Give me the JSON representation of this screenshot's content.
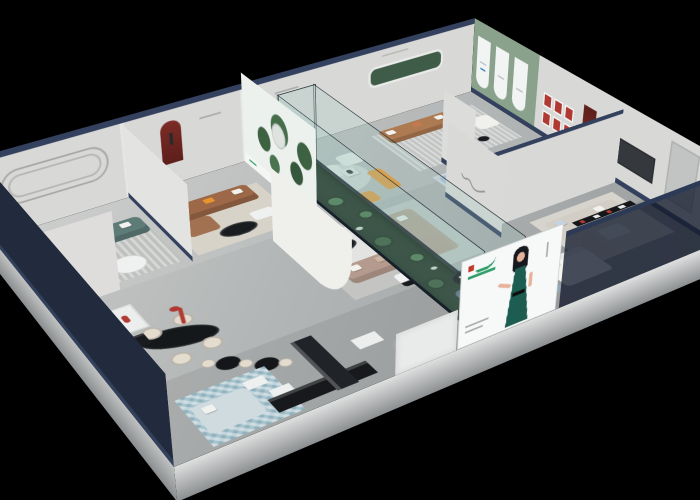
{
  "scene": {
    "description": "Isometric cutaway 3D render of a furniture showroom floor plan, dollhouse view on a black background",
    "view": "isometric-cutaway",
    "rooms": [
      {
        "id": "lounge-teal-sofa"
      },
      {
        "id": "lounge-brown-leather-sofa"
      },
      {
        "id": "statue-gallery-zone"
      },
      {
        "id": "lounge-caramel-sofa"
      },
      {
        "id": "lounge-blue-and-sage-sofas"
      },
      {
        "id": "center-taupe-sectional-lounge"
      },
      {
        "id": "glass-plant-atrium"
      },
      {
        "id": "beige-sectional-and-bed-room"
      },
      {
        "id": "front-slate-armchair-lounge"
      },
      {
        "id": "dining-display-zone"
      },
      {
        "id": "mosaic-display-corner"
      }
    ],
    "signage": [
      {
        "id": "forest-mural-poster"
      },
      {
        "id": "woman-in-green-dress-banner"
      },
      {
        "id": "script-logo-wall-decal"
      },
      {
        "id": "arched-display-panels"
      },
      {
        "id": "red-framed-picture-grid"
      }
    ]
  },
  "palette": {
    "bg": "#000000",
    "navy": "#222b3d",
    "navyCap": "#34415e",
    "navyGlass": "rgba(19,27,45,0.78)",
    "wallGrey": "#d8d8d6",
    "wallLight": "#e6e6e4",
    "slabA": "#dfe0e0",
    "slabB": "#8c8f91",
    "slabSide": "#585c60",
    "sage": "#8aa28c",
    "sageDark": "#3f5c49",
    "muralBase": "#edf1ee",
    "treeA": "#3c6242",
    "treeB": "#466e4b",
    "treeC": "#35583c",
    "sofaTeal": "#5d7b77",
    "sofaBrown": "#9c6847",
    "sofaCaramel": "#ad7a52",
    "sofaTaupe": "#b59b8d",
    "sofaBlue": "#aabdd3",
    "sofaSage": "#9cb2a0",
    "sofaBeige": "#d2cec5",
    "sofaSlate": "#5b7183",
    "bedWhite": "#f4f4f1",
    "bedBlue": "#cfdbdf",
    "poufBlue": "#92a9b4",
    "tableBlack": "#1a1d20",
    "tableWhite": "#eff1f0",
    "chairCream": "#e3dccf",
    "greyChair": "#b9bab6",
    "accentRed": "#b03a33",
    "nicheRed": "#7c2c26",
    "accentOrange": "#c57a4e",
    "accentYellow": "#e8952f",
    "pillowWhite": "#f1f1ee",
    "plantGreen": "#4d7a50",
    "plantDark": "#3a5c3f",
    "atriumFloor": "#233728",
    "glass": "rgba(150,195,188,0.22)",
    "glassEdge": "rgba(10,20,30,0.85)",
    "mosaicBase": "#a9c4cd",
    "rugGrey": "#bfc1bf",
    "rugBeige": "#d8d3c9",
    "rugBlue": "#ccd3dc",
    "rugWhite": "#e3e4e2",
    "bannerWhite": "#f7f8f8",
    "logoGreen": "#2e9e6b",
    "logoRed": "#c0392b",
    "dressGreen": "#1d5c50",
    "hairBlack": "#15181c",
    "skin": "#e7b29a",
    "textGrey": "#a9adab",
    "tvDark": "#35393d"
  }
}
